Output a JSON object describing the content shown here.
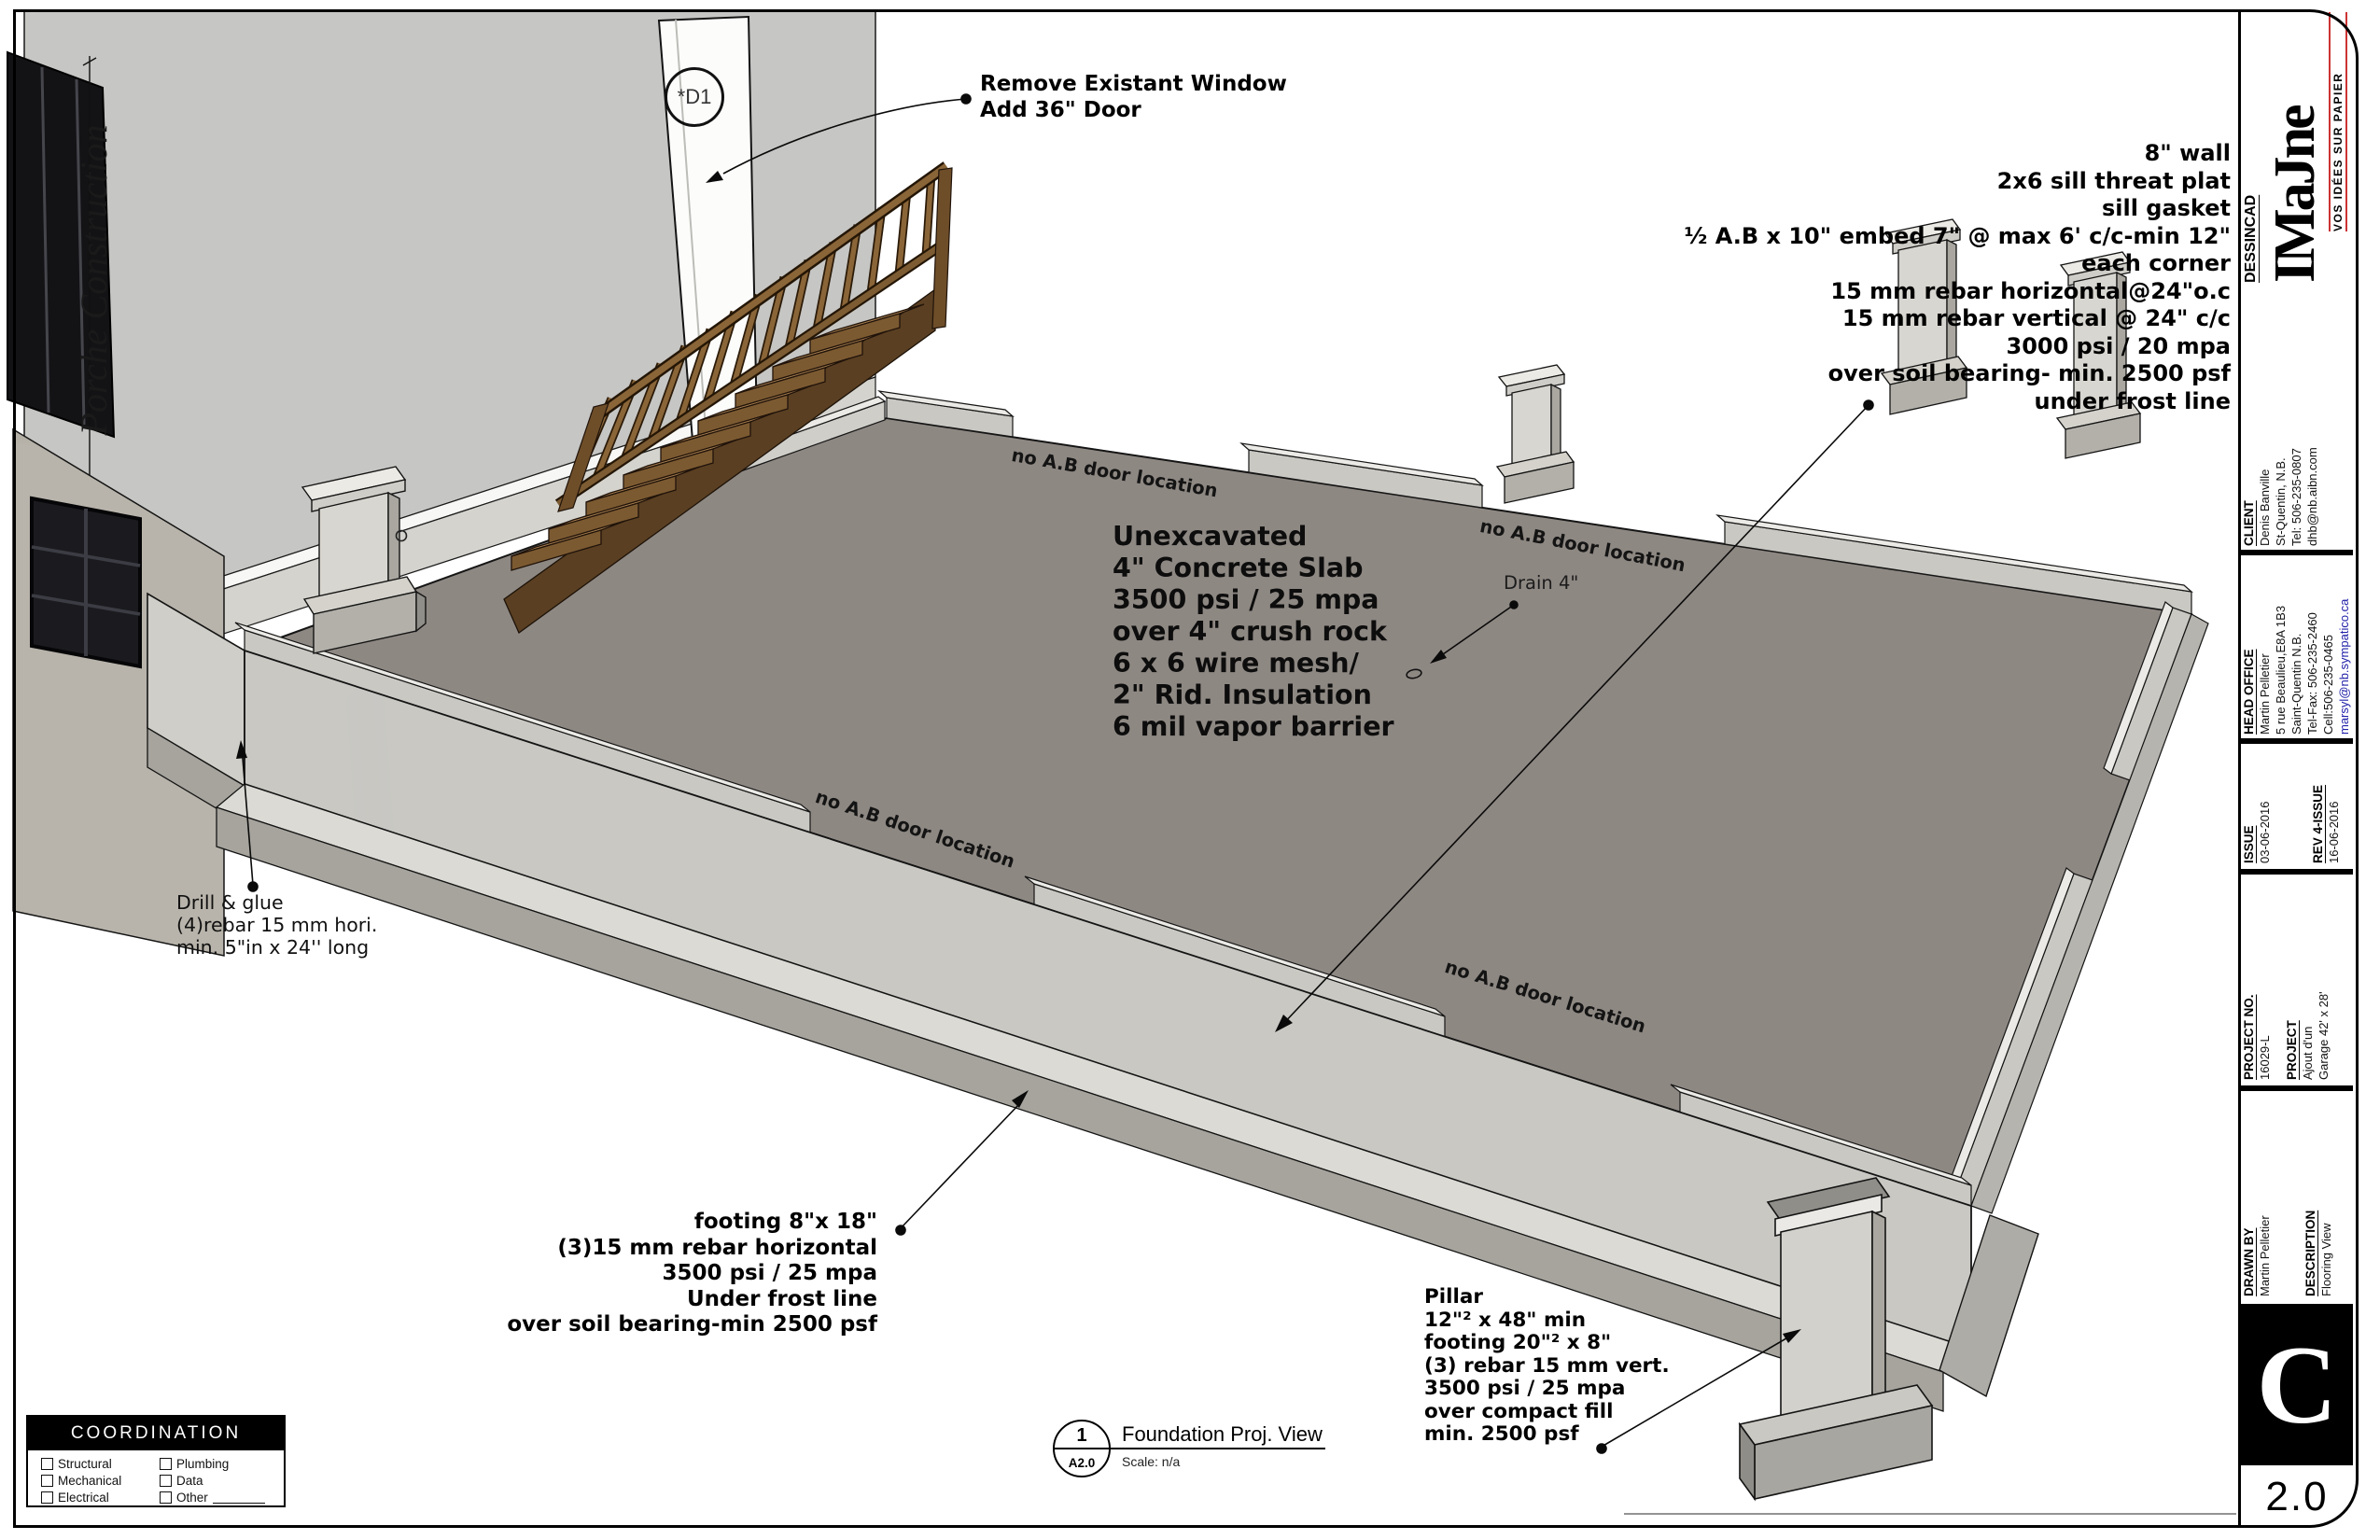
{
  "sheet_view": {
    "number": "1",
    "sheet_ref": "A2.0",
    "title": "Foundation Proj. View",
    "scale_label": "Scale:  n/a"
  },
  "revision": {
    "letter": "C",
    "number": "2.0"
  },
  "title_block": {
    "brand": {
      "name": "DESSINCAD",
      "logo": "IMaJne",
      "tagline": "VOS IDÉES SUR PAPIER"
    },
    "client": {
      "header": "CLIENT",
      "lines": [
        "Denis Banville",
        "St-Quentin, N.B.",
        "Tel: 506-235-0807",
        "dhb@nb.aibn.com"
      ]
    },
    "head_office": {
      "header": "HEAD OFFICE",
      "lines": [
        "Martin Pelletier",
        "5 rue Beaulieu,E8A 1B3",
        "Saint-Quentin N.B.",
        "Tel-Fax: 506-235-2460",
        "Cell:506-235-0465"
      ],
      "links": [
        "marsyl@nb.sympatico.ca",
        "www.dessicadimajne.com"
      ]
    },
    "issue": {
      "header": "ISSUE",
      "date": "03-06-2016"
    },
    "rev_issue": {
      "header": "REV 4-ISSUE",
      "date": "16-06-2016"
    },
    "project_no": {
      "header": "PROJECT NO.",
      "value": "16029-L"
    },
    "project": {
      "header": "PROJECT",
      "lines": [
        "Ajout d'un",
        "Garage 42' x 28'"
      ]
    },
    "drawn_by": {
      "header": "DRAWN BY",
      "value": "Martin Pelletier"
    },
    "description": {
      "header": "DESCRIPTION",
      "value": "Flooring View"
    }
  },
  "annotations": {
    "door_change": {
      "lines": [
        "Remove Existant Window",
        "Add 36\" Door"
      ]
    },
    "door_tag": "*D1",
    "wall_spec": {
      "lines": [
        "8\" wall",
        "2x6 sill threat plat",
        "sill gasket",
        "½ A.B x 10\" embed 7\"  @ max 6' c/c-min 12\"",
        "each corner",
        "15 mm rebar horizontal@24\"o.c",
        "15 mm rebar vertical @ 24\" c/c",
        "3000 psi / 20 mpa",
        "over soil bearing- min. 2500 psf",
        "under frost line"
      ]
    },
    "slab": {
      "lines": [
        "Unexcavated",
        "4\" Concrete Slab",
        "3500 psi / 25 mpa",
        "over 4\" crush rock",
        "6 x 6 wire mesh/",
        "2\" Rid. Insulation",
        "6 mil vapor barrier"
      ]
    },
    "drain": "Drain 4\"",
    "no_ab": "no A.B door location",
    "drill": {
      "lines": [
        "Drill & glue",
        "(4)rebar 15 mm hori.",
        "min. 5\"in x 24'' long"
      ]
    },
    "footing": {
      "lines": [
        "footing 8\"x 18\"",
        "(3)15 mm rebar horizontal",
        "3500 psi / 25 mpa",
        "Under frost line",
        "over soil bearing-min 2500 psf"
      ]
    },
    "pillar": {
      "lines": [
        "Pillar",
        "12\"² x 48\" min",
        "footing 20\"² x 8\"",
        "(3) rebar 15 mm vert.",
        "3500 psi / 25 mpa",
        "over compact fill",
        "min. 2500 psf"
      ]
    },
    "porch_script": "Porche Construction"
  },
  "coordination": {
    "title": "COORDINATION",
    "left_items": [
      "Structural",
      "Mechanical",
      "Electrical"
    ],
    "right_items": [
      "Plumbing",
      "Data",
      "Other"
    ]
  },
  "colors": {
    "paper": "#ffffff",
    "ink": "#000000",
    "slab": "#8e8883",
    "concrete": "#c9c8c3",
    "wood": "#a8804e",
    "link_blue": "#2222aa",
    "logo_red": "#cc3333"
  }
}
